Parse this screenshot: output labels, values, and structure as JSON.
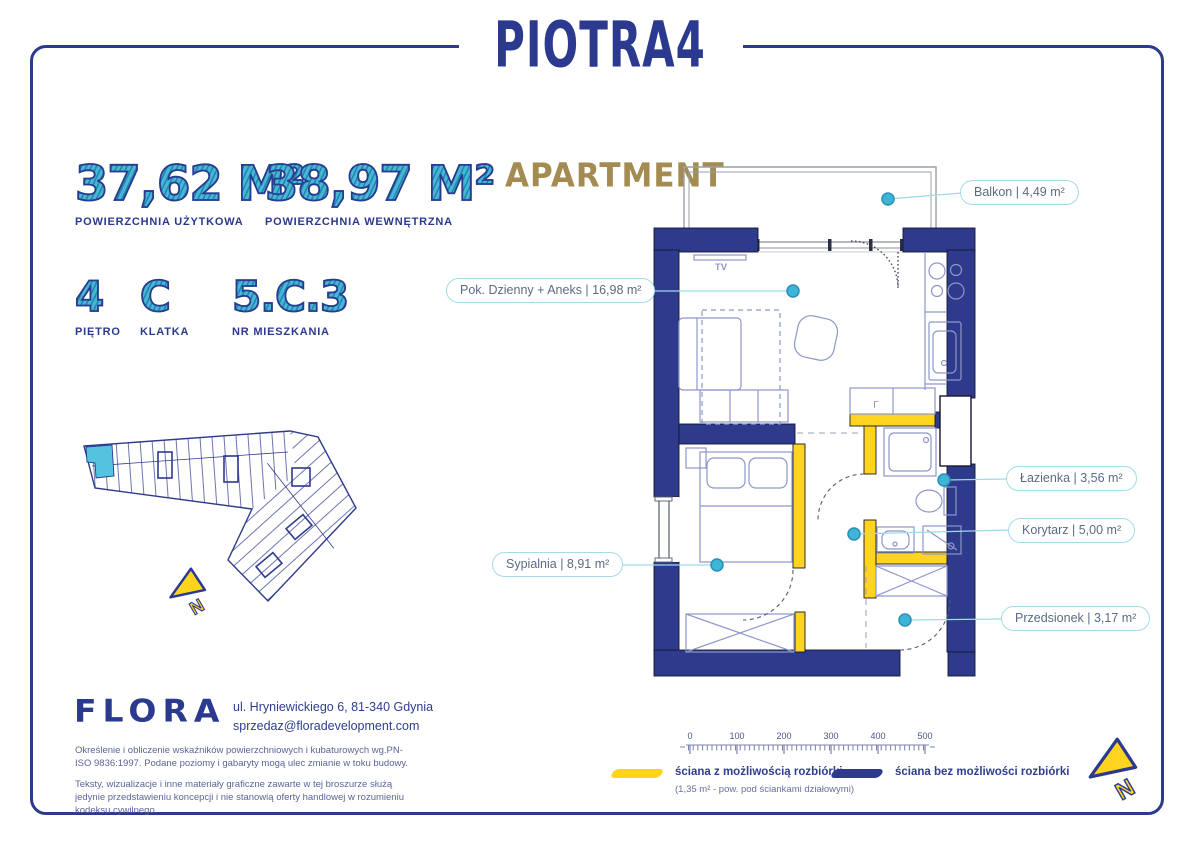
{
  "brand": {
    "name": "PIOTRA4"
  },
  "headings": {
    "apartment": "APARTMENT"
  },
  "stats": [
    {
      "value": "37,62 M²",
      "label": "POWIERZCHNIA UŻYTKOWA"
    },
    {
      "value": "38,97 M²",
      "label": "POWIERZCHNIA WEWNĘTRZNA"
    }
  ],
  "unit_info": [
    {
      "value": "4",
      "label": "PIĘTRO"
    },
    {
      "value": "C",
      "label": "KLATKA"
    },
    {
      "value": "5.C.3",
      "label": "NR MIESZKANIA"
    }
  ],
  "rooms": [
    {
      "label": "Balkon | 4,49 m²"
    },
    {
      "label": "Pok. Dzienny + Aneks | 16,98 m²"
    },
    {
      "label": "Łazienka | 3,56 m²"
    },
    {
      "label": "Korytarz | 5,00 m²"
    },
    {
      "label": "Sypialnia | 8,91 m²"
    },
    {
      "label": "Przedsionek | 3,17 m²"
    }
  ],
  "plan": {
    "tv_label": "TV",
    "fridge_label": "Γ",
    "north_label": "N"
  },
  "scale_bar": {
    "ticks": [
      "0",
      "100",
      "200",
      "300",
      "400",
      "500"
    ]
  },
  "legend": [
    {
      "label": "ściana z możliwością rozbiórki",
      "note": "(1,35 m² - pow. pod ściankami działowymi)",
      "color": "#ffd41f"
    },
    {
      "label": "ściana bez możliwości rozbiórki",
      "note": "",
      "color": "#2e3a8c"
    }
  ],
  "footer": {
    "company": "FLORA",
    "address": "ul. Hryniewickiego 6, 81-340 Gdynia",
    "email": "sprzedaz@floradevelopment.com",
    "disclaimer_1": "Określenie i obliczenie wskaźników powierzchniowych i kubaturowych wg.PN- ISO 9836:1997. Podane poziomy i gabaryty mogą ulec zmianie w toku budowy.",
    "disclaimer_2": "Teksty, wizualizacje i inne materiały graficzne zawarte w tej broszurze służą jedynie przedstawieniu koncepcji i nie stanowią oferty handlowej w rozumieniu kodeksu cywilnego."
  },
  "colors": {
    "navy": "#2b3a8f",
    "teal_number": "#41b0d4",
    "gold": "#a38b51",
    "removable_wall_yellow": "#ffd41f",
    "unit_highlight": "#54c4de",
    "pill_border": "#a5dbe9"
  }
}
